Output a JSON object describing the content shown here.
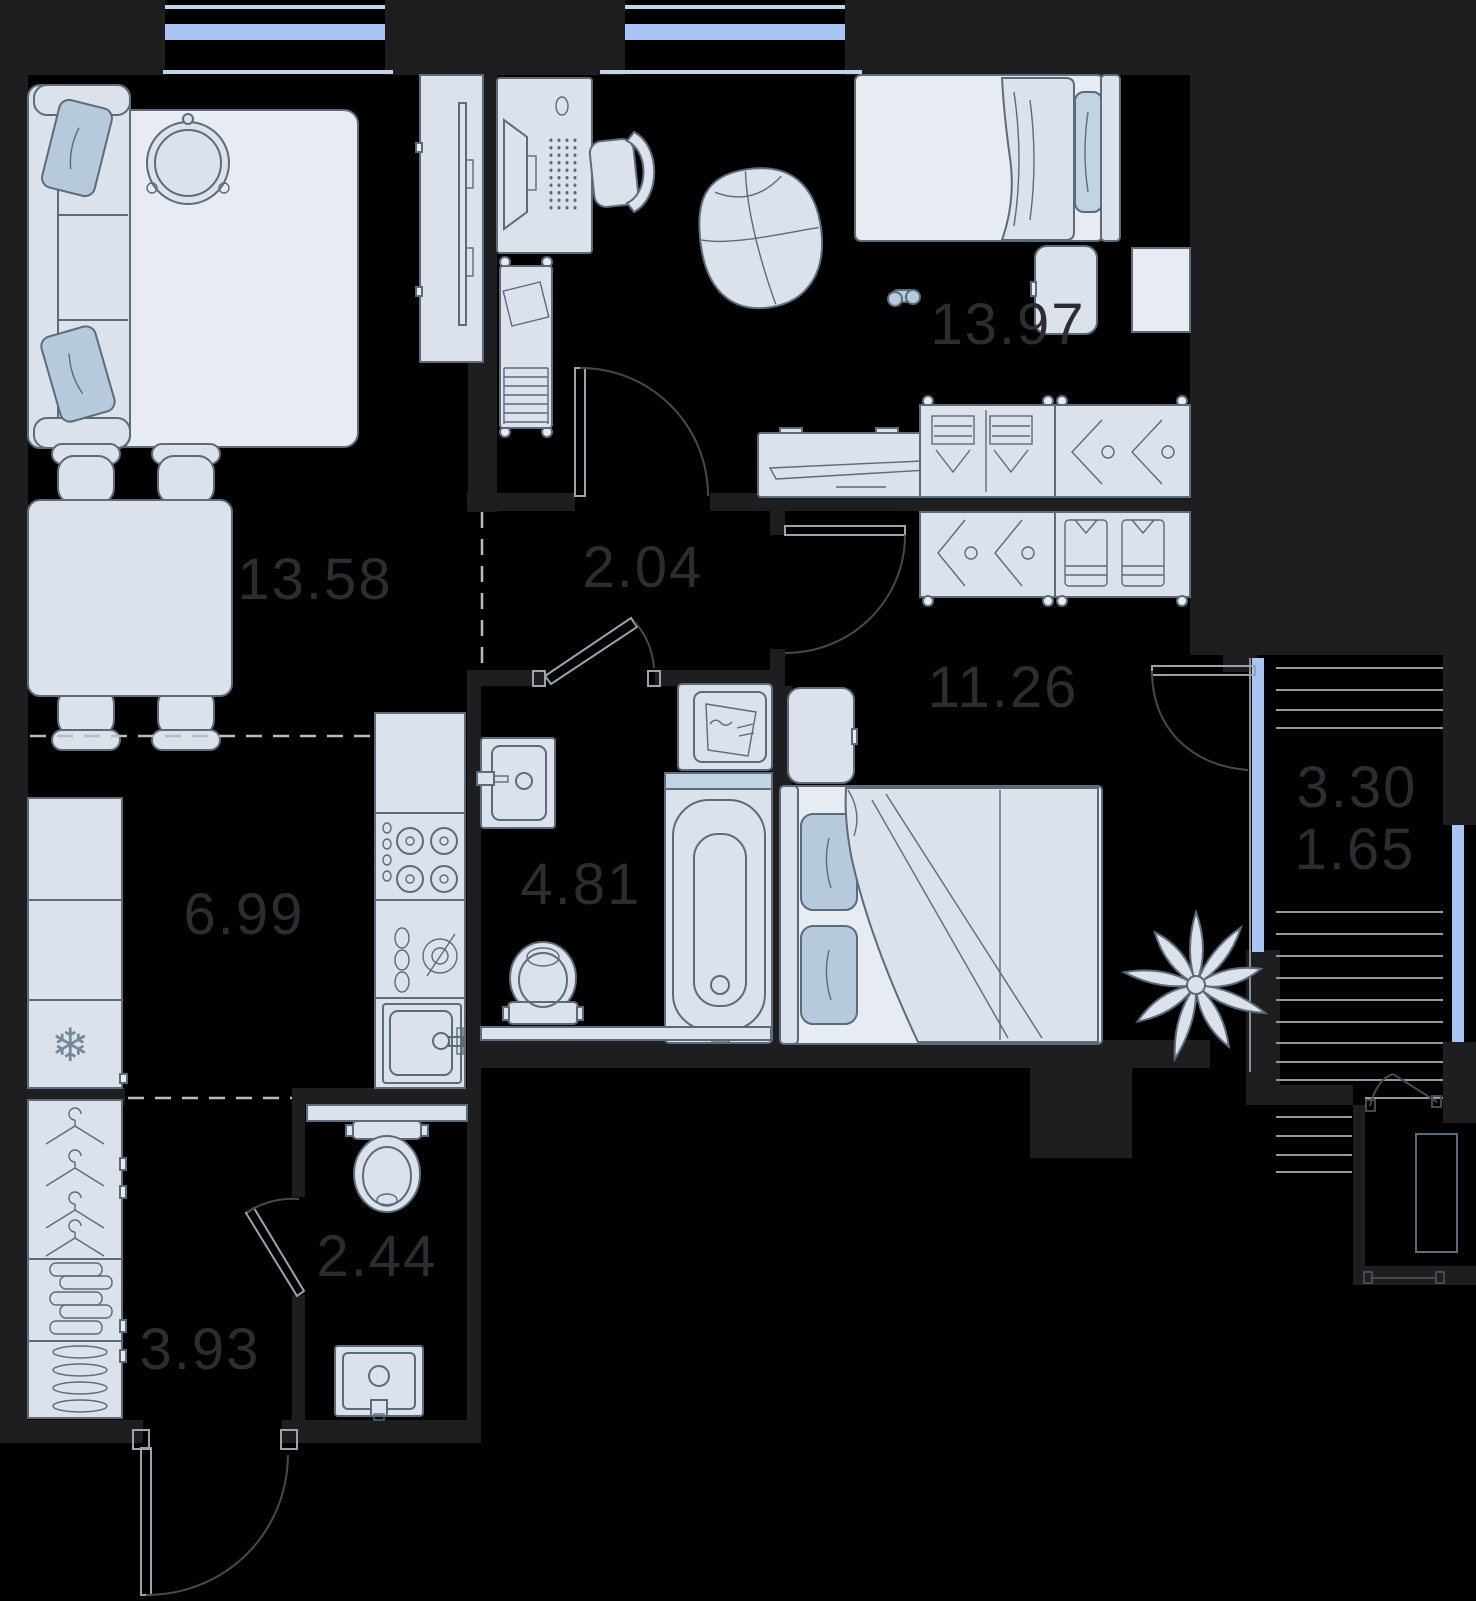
{
  "plan_type": "apartment floor plan",
  "icons": {
    "freezer": "❄"
  },
  "rooms": [
    {
      "name": "bedroom-1",
      "area": "13.97"
    },
    {
      "name": "living-dining",
      "area": "13.58"
    },
    {
      "name": "hallway",
      "area": "2.04"
    },
    {
      "name": "bedroom-2",
      "area": "11.26"
    },
    {
      "name": "balcony-full",
      "area": "3.30"
    },
    {
      "name": "balcony-reduced",
      "area": "1.65"
    },
    {
      "name": "kitchen",
      "area": "6.99"
    },
    {
      "name": "bathroom",
      "area": "4.81"
    },
    {
      "name": "wc",
      "area": "2.44"
    },
    {
      "name": "entry-hall",
      "area": "3.93"
    }
  ],
  "colors": {
    "background": "#000000",
    "wall": "#1e1e20",
    "furniture_fill": "#dbe2ec",
    "furniture_light": "#e7ecf3",
    "pillow_accent": "#b7c9dc",
    "window_glass": "#a8c6f4",
    "window_sill": "#c3d3e8",
    "deck_line": "#95999e",
    "zone_dash": "#b8bdc2",
    "area_label": "#2b2d30",
    "door_arc": "#46494d"
  }
}
